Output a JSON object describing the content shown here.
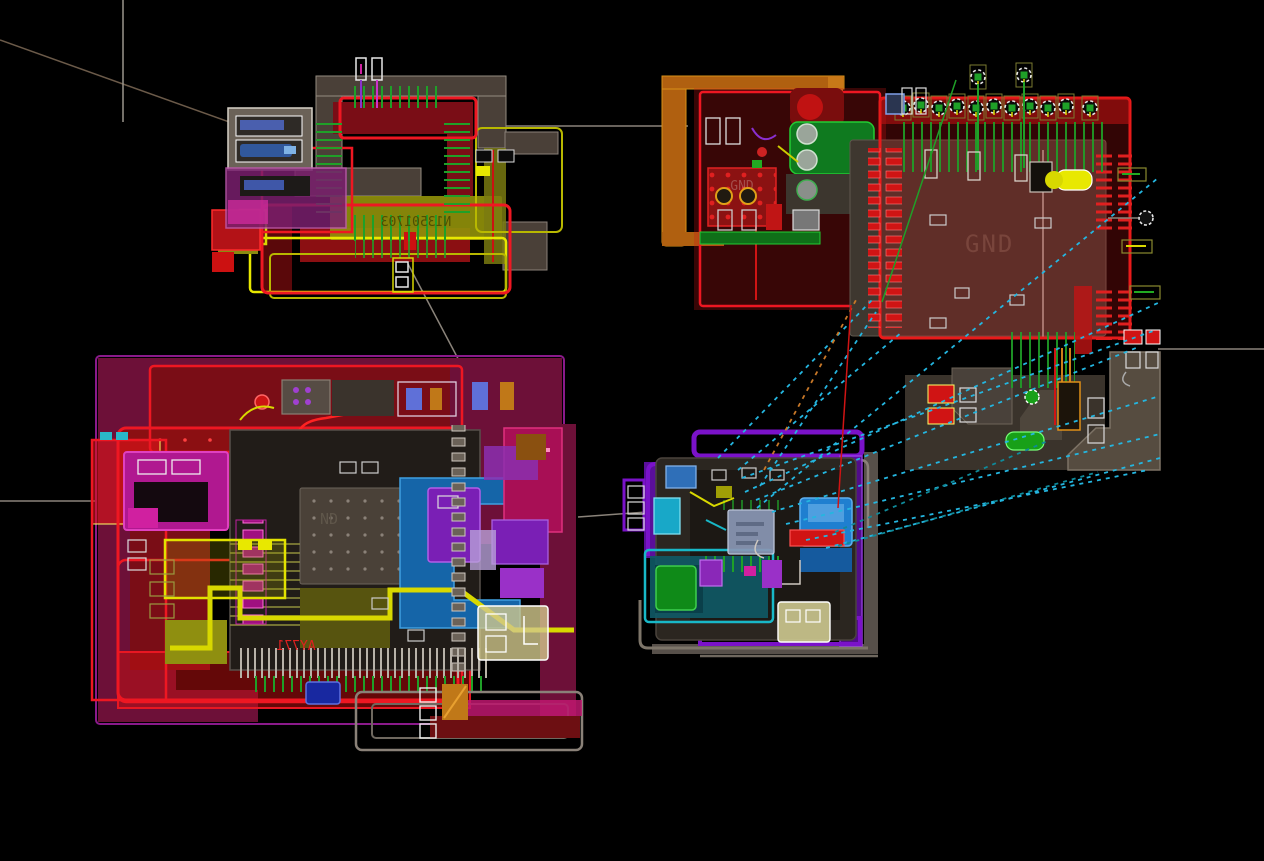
{
  "canvas": {
    "kind": "pcb-layout-view",
    "width": 1264,
    "height": 861,
    "background": "#000000"
  },
  "labels": {
    "gnd_plane_tr": "GND",
    "gnd_faint_tr": "GND",
    "gnd_partial_bl": "ND",
    "silkscreen_tl_mirrored": "N13501703",
    "silkscreen_bl_mirrored": "AY771"
  },
  "palette": {
    "bright_red": "#e81722",
    "dark_red": "#7a0d16",
    "maroon": "#8b0f12",
    "yellow": "#d8d800",
    "olive": "#8f8f0a",
    "green_trace": "#1fa028",
    "bright_green": "#22cc33",
    "ratsnest_cyan": "#24b6e0",
    "teal": "#0f7a8a",
    "steel_blue": "#1565a8",
    "bright_blue": "#1f7fd0",
    "purple": "#7a12c9",
    "violet": "#9a30c8",
    "magenta": "#c01890",
    "dark_magenta": "#6d1038",
    "orange_frame": "#b06010",
    "pour_gray": "#3e372f",
    "taupe": "#4a4138",
    "silk_gray": "#8a8178",
    "pad_white": "#e8e8e8"
  },
  "modules": [
    {
      "id": "module-top-left"
    },
    {
      "id": "module-top-right"
    },
    {
      "id": "module-bottom-left"
    },
    {
      "id": "module-bottom-center"
    }
  ]
}
